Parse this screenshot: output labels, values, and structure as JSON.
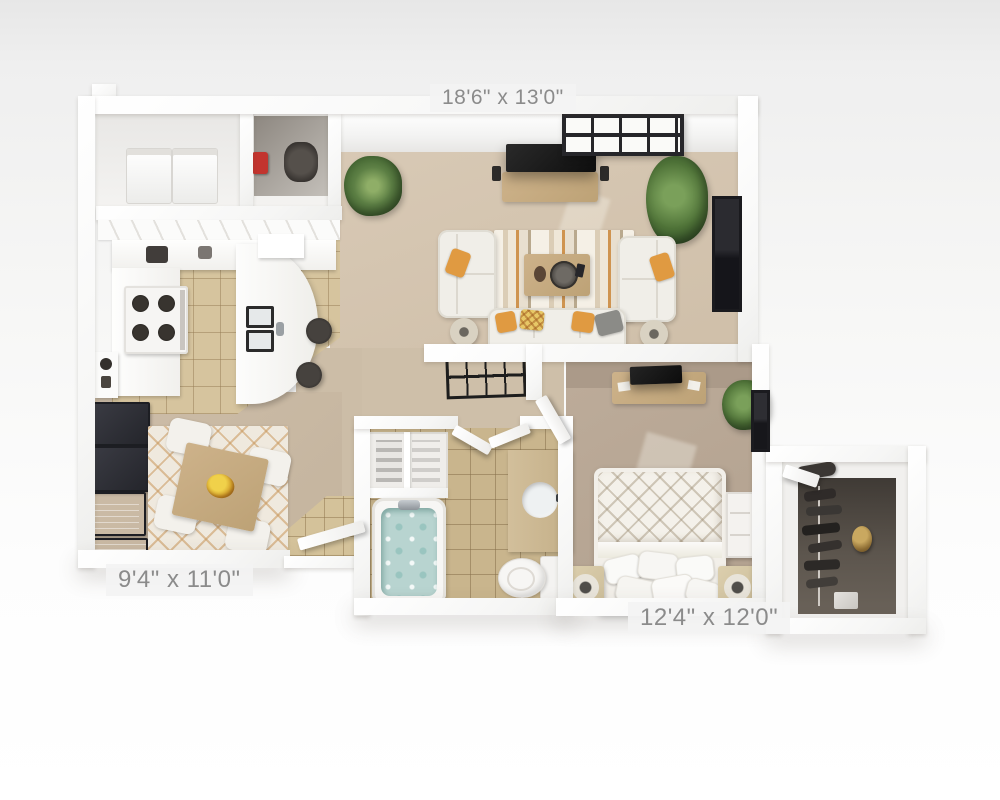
{
  "image_type": "3D top-down apartment floor plan render",
  "dimension_labels": {
    "living_room": "18'6\" x 13'0\"",
    "dining_area": "9'4\" x 11'0\"",
    "bedroom": "12'4\" x 12'0\""
  },
  "rooms": [
    {
      "name": "living-room",
      "dimensions": "18'6\" x 13'0\"",
      "features": [
        "tv-console-with-tv",
        "window-top-wall",
        "window-right-wall",
        "corner-plant",
        "palm-plant",
        "two-facing-sofas",
        "bottom-loveseat",
        "striped-area-rug",
        "coffee-table-with-tray",
        "two-floor-lamps",
        "orange-accent-pillows"
      ]
    },
    {
      "name": "kitchen",
      "features": [
        "l-shaped-white-cabinets",
        "range-four-burners",
        "curved-breakfast-bar",
        "double-sink",
        "two-bar-stools",
        "tan-tile-floor"
      ]
    },
    {
      "name": "laundry-closet",
      "features": [
        "washer",
        "dryer",
        "red-detergent",
        "utility-heater"
      ]
    },
    {
      "name": "dining-area",
      "dimensions": "9'4\" x 11'0\"",
      "features": [
        "square-wood-table",
        "four-white-chairs",
        "fruit-bowl",
        "diamond-lattice-rug",
        "four-dark-wall-frames"
      ]
    },
    {
      "name": "hallway",
      "features": [
        "metal-console-table",
        "bedroom-door"
      ]
    },
    {
      "name": "bathroom",
      "features": [
        "soaking-tub",
        "vanity-with-round-sink",
        "toilet",
        "linen-closet-with-towels",
        "tan-tile-floor",
        "double-door"
      ]
    },
    {
      "name": "bedroom",
      "dimensions": "12'4\" x 12'0\"",
      "features": [
        "bed-diamond-quilt",
        "pillow-cluster",
        "two-nightstands-with-lamps",
        "desk-with-tv",
        "dresser",
        "plant",
        "window-right-wall"
      ]
    },
    {
      "name": "walk-in-closet",
      "features": [
        "hanging-clothes",
        "clothes-rod",
        "gold-bag",
        "shoe-box",
        "closet-door"
      ]
    },
    {
      "name": "entry",
      "features": [
        "open-front-door",
        "tile-landing"
      ]
    }
  ],
  "palette": {
    "walls": "#ffffff",
    "living_carpet": "#d3c3ae",
    "bedroom_carpet": "#b8a795",
    "dining_carpet": "#c9b9a3",
    "kitchen_tile": "#d6c49e",
    "bath_tile": "#c9b58d",
    "accent_orange": "#e09a41",
    "plant_green": "#4f7338",
    "tub_water": "#b8d4d0",
    "label_text": "#8b8b8b",
    "background": "#f2f2f2"
  }
}
